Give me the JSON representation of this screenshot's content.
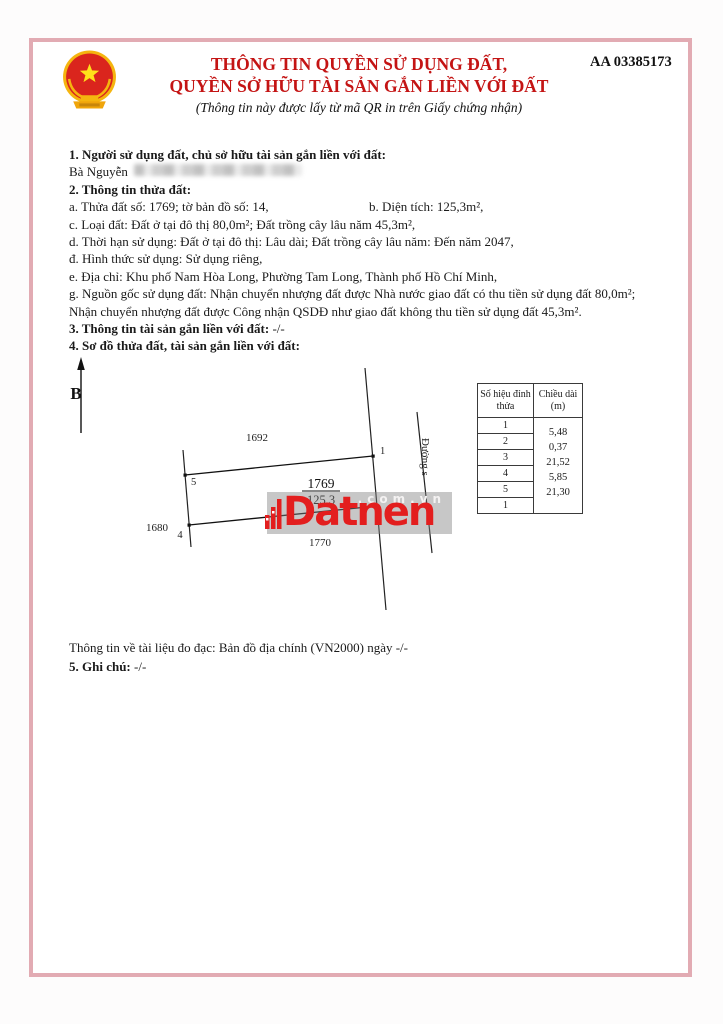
{
  "serial": "AA 03385173",
  "header": {
    "title_line1": "THÔNG TIN QUYỀN SỬ DỤNG ĐẤT,",
    "title_line2": "QUYỀN SỞ HỮU TÀI SẢN GẮN LIỀN VỚI ĐẤT",
    "subtitle": "(Thông tin này được lấy từ mã QR in trên Giấy chứng nhận)",
    "title_color": "#c41414",
    "emblem": "vietnam-national-emblem"
  },
  "sections": {
    "s1_heading": "1. Người sử dụng đất, chủ sở hữu tài sản gắn liền với đất:",
    "owner_prefix": "Bà Nguyễn",
    "s2_heading": "2. Thông tin thửa đất:",
    "line_a": "a. Thửa đất số: 1769; tờ bản đồ số: 14,",
    "line_b": "b. Diện tích: 125,3m²,",
    "line_c": "c. Loại đất: Đất ở tại đô thị 80,0m²; Đất trồng cây lâu năm 45,3m²,",
    "line_d": "d. Thời hạn sử dụng: Đất ở tại đô thị: Lâu dài; Đất trồng cây lâu năm: Đến năm 2047,",
    "line_dd": "đ. Hình thức sử dụng: Sử dụng riêng,",
    "line_e": "e. Địa chỉ: Khu phố Nam Hòa Long, Phường Tam Long, Thành phố Hồ Chí Minh,",
    "line_g1": "g. Nguồn gốc sử dụng đất: Nhận chuyển nhượng đất được Nhà nước giao đất có thu tiền sử dụng đất 80,0m²;",
    "line_g2": "Nhận chuyển nhượng đất được Công nhận QSDĐ như giao đất không thu tiền sử dụng đất 45,3m².",
    "s3_heading": "3. Thông tin tài sản gắn liền với đất:",
    "s3_value": "-/-",
    "s4_heading": "4. Sơ đồ thửa đất, tài sản gắn liền với đất:",
    "measurement_note": "Thông tin về tài liệu đo đạc: Bản đồ địa chính (VN2000) ngày -/-",
    "s5_heading": "5. Ghi chú:",
    "s5_value": "-/-"
  },
  "diagram": {
    "north_label": "B",
    "parcel_number": "1769",
    "parcel_area": "125,3",
    "adjacent_top": "1692",
    "adjacent_left": "1680",
    "adjacent_bottom": "1770",
    "road_label": "Đường s",
    "vertex_1": "1",
    "vertex_5": "5",
    "vertex_4": "4",
    "table": {
      "col1_header": "Số hiệu đỉnh thửa",
      "col2_header": "Chiều dài (m)",
      "vertex_ids": [
        "1",
        "2",
        "3",
        "4",
        "5",
        "1"
      ],
      "lengths": [
        "5,48",
        "0,37",
        "21,52",
        "5,85",
        "21,30"
      ]
    }
  },
  "watermark": {
    "brand": "Datnen",
    "domain": ".com.vn",
    "color": "#e31e1e"
  }
}
